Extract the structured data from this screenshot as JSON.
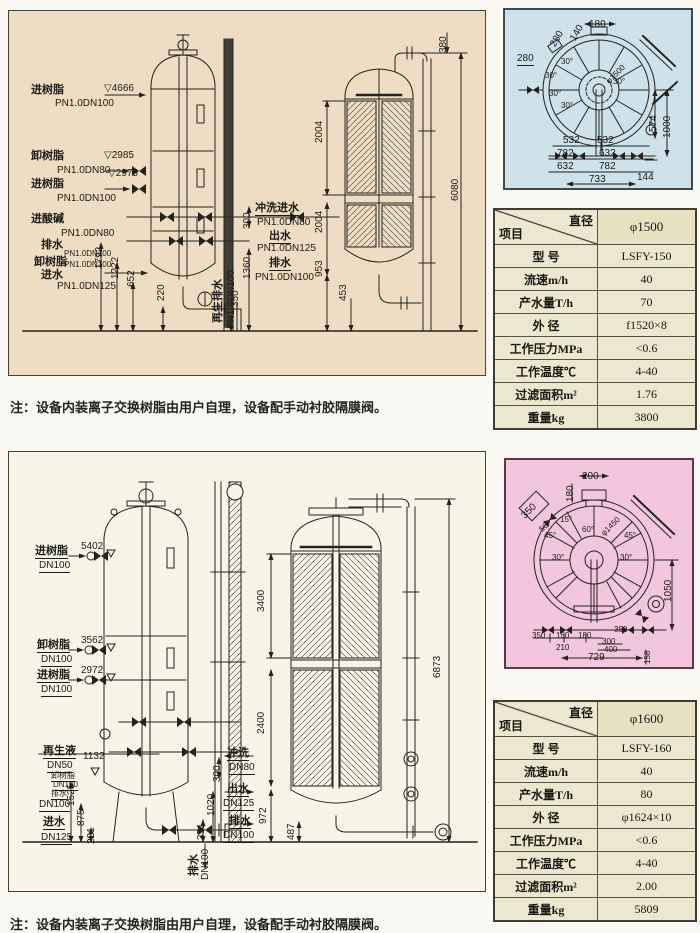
{
  "note_top": "注：设备内装离子交换树脂由用户自理，设备配手动衬胶隔膜阀。",
  "note_bottom": "注：设备内装离子交换树脂由用户自理，设备配手动衬胶隔膜阀。",
  "colors": {
    "top_panel_bg": "#eeddc3",
    "bottom_panel_bg": "#f6f5e8",
    "blue_view_bg": "#cde2ea",
    "pink_view_bg": "#f2c6de",
    "table_bg": "#ebe8cf",
    "line": "#23221e"
  },
  "table_top": {
    "header_diag_top": "直径",
    "header_diag_bottom": "项目",
    "header_value": "φ1500",
    "rows": [
      {
        "label": "型  号",
        "value": "LSFY-150"
      },
      {
        "label": "流速m/h",
        "value": "40"
      },
      {
        "label": "产水量T/h",
        "value": "70"
      },
      {
        "label": "外  径",
        "value": "f1520×8"
      },
      {
        "label": "工作压力MPa",
        "value": "<0.6"
      },
      {
        "label": "工作温度℃",
        "value": "4-40"
      },
      {
        "label": "过滤面积m²",
        "value": "1.76"
      },
      {
        "label": "重量kg",
        "value": "3800"
      }
    ]
  },
  "table_bottom": {
    "header_diag_top": "直径",
    "header_diag_bottom": "项目",
    "header_value": "φ1600",
    "rows": [
      {
        "label": "型  号",
        "value": "LSFY-160"
      },
      {
        "label": "流速m/h",
        "value": "40"
      },
      {
        "label": "产水量T/h",
        "value": "80"
      },
      {
        "label": "外  径",
        "value": "φ1624×10"
      },
      {
        "label": "工作压力MPa",
        "value": "<0.6"
      },
      {
        "label": "工作温度℃",
        "value": "4-40"
      },
      {
        "label": "过滤面积m²",
        "value": "2.00"
      },
      {
        "label": "重量kg",
        "value": "5809"
      }
    ]
  },
  "drawing_top": {
    "labels": [
      {
        "t": "进树脂",
        "x": 22,
        "y": 74,
        "c": "cn"
      },
      {
        "t": "PN1.0DN100",
        "x": 46,
        "y": 88
      },
      {
        "t": "▽4666",
        "x": 95,
        "y": 73
      },
      {
        "t": "卸树脂",
        "x": 22,
        "y": 140,
        "c": "cn"
      },
      {
        "t": "▽2985",
        "x": 95,
        "y": 140
      },
      {
        "t": "PN1.0DN80",
        "x": 48,
        "y": 155
      },
      {
        "t": "▽2975",
        "x": 99,
        "y": 158
      },
      {
        "t": "进树脂",
        "x": 22,
        "y": 168,
        "c": "cn"
      },
      {
        "t": "PN1.0DN100",
        "x": 48,
        "y": 183
      },
      {
        "t": "进酸碱",
        "x": 22,
        "y": 203,
        "c": "cn"
      },
      {
        "t": "PN1.0DN80",
        "x": 52,
        "y": 218
      },
      {
        "t": "排水",
        "x": 32,
        "y": 229,
        "c": "cn"
      },
      {
        "t": "PN1.0DN100",
        "x": 55,
        "y": 239,
        "c": "s"
      },
      {
        "t": "卸树脂",
        "x": 25,
        "y": 246,
        "c": "cn"
      },
      {
        "t": "PN1.0DN100",
        "x": 55,
        "y": 250,
        "c": "s"
      },
      {
        "t": "进水",
        "x": 32,
        "y": 259,
        "c": "cn"
      },
      {
        "t": "PN1.0DN125",
        "x": 48,
        "y": 271
      },
      {
        "t": "冲洗进水",
        "x": 246,
        "y": 192,
        "c": "cn u"
      },
      {
        "t": "PN1.0DN80",
        "x": 248,
        "y": 207
      },
      {
        "t": "出水",
        "x": 260,
        "y": 220,
        "c": "cn u"
      },
      {
        "t": "PN1.0DN125",
        "x": 248,
        "y": 233
      },
      {
        "t": "排水",
        "x": 260,
        "y": 247,
        "c": "cn u"
      },
      {
        "t": "PN1.0DN100",
        "x": 246,
        "y": 262
      },
      {
        "t": "1792",
        "x": 86,
        "y": 258,
        "c": "r"
      },
      {
        "t": "1222",
        "x": 102,
        "y": 268,
        "c": "r"
      },
      {
        "t": "652",
        "x": 118,
        "y": 276,
        "c": "r"
      },
      {
        "t": "220",
        "x": 148,
        "y": 290,
        "c": "r"
      },
      {
        "t": "350",
        "x": 222,
        "y": 296,
        "c": "r"
      },
      {
        "t": "再生排水",
        "x": 204,
        "y": 312,
        "c": "r cn"
      },
      {
        "t": "PN1.0DN100",
        "x": 218,
        "y": 318,
        "c": "r"
      },
      {
        "t": "300",
        "x": 234,
        "y": 218,
        "c": "r"
      },
      {
        "t": "1360",
        "x": 234,
        "y": 268,
        "c": "r"
      },
      {
        "t": "2004",
        "x": 306,
        "y": 132,
        "c": "r"
      },
      {
        "t": "2004",
        "x": 306,
        "y": 222,
        "c": "r"
      },
      {
        "t": "953",
        "x": 306,
        "y": 266,
        "c": "r"
      },
      {
        "t": "453",
        "x": 330,
        "y": 290,
        "c": "r"
      },
      {
        "t": "380",
        "x": 430,
        "y": 42,
        "c": "r"
      },
      {
        "t": "6080",
        "x": 442,
        "y": 190,
        "c": "r"
      }
    ]
  },
  "drawing_bottom": {
    "labels": [
      {
        "t": "进树脂",
        "x": 26,
        "y": 94,
        "c": "cn u"
      },
      {
        "t": "DN100",
        "x": 30,
        "y": 109,
        "c": "u"
      },
      {
        "t": "5402",
        "x": 72,
        "y": 90
      },
      {
        "t": "卸树脂",
        "x": 28,
        "y": 188,
        "c": "cn u"
      },
      {
        "t": "DN100",
        "x": 32,
        "y": 203,
        "c": "u"
      },
      {
        "t": "3562",
        "x": 72,
        "y": 184
      },
      {
        "t": "进树脂",
        "x": 28,
        "y": 218,
        "c": "cn u"
      },
      {
        "t": "DN100",
        "x": 32,
        "y": 233,
        "c": "u"
      },
      {
        "t": "2972",
        "x": 72,
        "y": 214
      },
      {
        "t": "再生液",
        "x": 34,
        "y": 294,
        "c": "cn u"
      },
      {
        "t": "DN50",
        "x": 38,
        "y": 309,
        "c": "u"
      },
      {
        "t": "1132",
        "x": 74,
        "y": 300
      },
      {
        "t": "卸树脂",
        "x": 42,
        "y": 320,
        "c": "s u"
      },
      {
        "t": "DN100",
        "x": 44,
        "y": 329,
        "c": "s u"
      },
      {
        "t": "排水",
        "x": 42,
        "y": 338,
        "c": "s u"
      },
      {
        "t": "DN100",
        "x": 30,
        "y": 348,
        "c": "u"
      },
      {
        "t": "1525",
        "x": 58,
        "y": 354,
        "c": "r"
      },
      {
        "t": "进水",
        "x": 34,
        "y": 365,
        "c": "cn u"
      },
      {
        "t": "DN125",
        "x": 32,
        "y": 381,
        "c": "u"
      },
      {
        "t": "875",
        "x": 68,
        "y": 374,
        "c": "r"
      },
      {
        "t": "221",
        "x": 78,
        "y": 392,
        "c": "r"
      },
      {
        "t": "冲洗",
        "x": 218,
        "y": 296,
        "c": "cn u"
      },
      {
        "t": "DN80",
        "x": 220,
        "y": 311,
        "c": "u"
      },
      {
        "t": "300",
        "x": 204,
        "y": 330,
        "c": "r"
      },
      {
        "t": "出水",
        "x": 218,
        "y": 332,
        "c": "cn u"
      },
      {
        "t": "DN125",
        "x": 214,
        "y": 347,
        "c": "u"
      },
      {
        "t": "1020",
        "x": 198,
        "y": 364,
        "c": "r"
      },
      {
        "t": "排水",
        "x": 220,
        "y": 364,
        "c": "cn u"
      },
      {
        "t": "DN100",
        "x": 214,
        "y": 379,
        "c": "u"
      },
      {
        "t": "351",
        "x": 188,
        "y": 388,
        "c": "r"
      },
      {
        "t": "排水",
        "x": 180,
        "y": 424,
        "c": "r cn"
      },
      {
        "t": "DN100",
        "x": 192,
        "y": 428,
        "c": "r"
      },
      {
        "t": "3400",
        "x": 248,
        "y": 160,
        "c": "r"
      },
      {
        "t": "2400",
        "x": 248,
        "y": 282,
        "c": "r"
      },
      {
        "t": "972",
        "x": 250,
        "y": 372,
        "c": "r"
      },
      {
        "t": "487",
        "x": 278,
        "y": 388,
        "c": "r"
      },
      {
        "t": "6873",
        "x": 424,
        "y": 226,
        "c": "r"
      }
    ]
  },
  "topview_blue": {
    "labels": [
      {
        "t": "180",
        "x": 84,
        "y": 10
      },
      {
        "t": "140",
        "x": 64,
        "y": 28,
        "c": "r60"
      },
      {
        "t": "280",
        "x": 44,
        "y": 34,
        "c": "r60"
      },
      {
        "t": "280",
        "x": 12,
        "y": 44,
        "c": "u"
      },
      {
        "t": "30°",
        "x": 56,
        "y": 48,
        "c": "s"
      },
      {
        "t": "30°",
        "x": 40,
        "y": 62,
        "c": "s"
      },
      {
        "t": "30°",
        "x": 44,
        "y": 80,
        "c": "s"
      },
      {
        "t": "30°",
        "x": 108,
        "y": 68,
        "c": "s"
      },
      {
        "t": "30°",
        "x": 56,
        "y": 92,
        "c": "s"
      },
      {
        "t": "φ1500",
        "x": 100,
        "y": 70,
        "c": "r45 s"
      },
      {
        "t": "574",
        "x": 144,
        "y": 122,
        "c": "r"
      },
      {
        "t": "1000",
        "x": 158,
        "y": 128,
        "c": "r"
      },
      {
        "t": "532",
        "x": 58,
        "y": 126
      },
      {
        "t": "532",
        "x": 92,
        "y": 126
      },
      {
        "t": "782",
        "x": 52,
        "y": 139
      },
      {
        "t": "632",
        "x": 94,
        "y": 139
      },
      {
        "t": "632",
        "x": 52,
        "y": 152
      },
      {
        "t": "782",
        "x": 94,
        "y": 152
      },
      {
        "t": "733",
        "x": 84,
        "y": 165
      },
      {
        "t": "144",
        "x": 132,
        "y": 163
      }
    ]
  },
  "topview_pink": {
    "labels": [
      {
        "t": "200",
        "x": 76,
        "y": 12
      },
      {
        "t": "180",
        "x": 60,
        "y": 42,
        "c": "r"
      },
      {
        "t": "350",
        "x": 14,
        "y": 54,
        "c": "r45"
      },
      {
        "t": "56",
        "x": 32,
        "y": 68,
        "c": "r45 s"
      },
      {
        "t": "15°",
        "x": 54,
        "y": 56,
        "c": "s"
      },
      {
        "t": "45°",
        "x": 38,
        "y": 72,
        "c": "s"
      },
      {
        "t": "45°",
        "x": 118,
        "y": 72,
        "c": "s"
      },
      {
        "t": "60°",
        "x": 76,
        "y": 66,
        "c": "s"
      },
      {
        "t": "φ1450",
        "x": 94,
        "y": 72,
        "c": "r45 s"
      },
      {
        "t": "30°",
        "x": 46,
        "y": 94,
        "c": "s"
      },
      {
        "t": "30°",
        "x": 114,
        "y": 94,
        "c": "s"
      },
      {
        "t": "1050",
        "x": 158,
        "y": 142,
        "c": "r"
      },
      {
        "t": "350",
        "x": 26,
        "y": 172,
        "c": "s"
      },
      {
        "t": "150",
        "x": 50,
        "y": 172,
        "c": "s"
      },
      {
        "t": "180",
        "x": 72,
        "y": 172,
        "c": "s"
      },
      {
        "t": "350",
        "x": 108,
        "y": 166,
        "c": "s"
      },
      {
        "t": "210",
        "x": 50,
        "y": 184,
        "c": "s"
      },
      {
        "t": "300",
        "x": 96,
        "y": 178,
        "c": "s"
      },
      {
        "t": "400",
        "x": 98,
        "y": 186,
        "c": "s"
      },
      {
        "t": "729",
        "x": 82,
        "y": 193
      },
      {
        "t": "158",
        "x": 138,
        "y": 204,
        "c": "r s"
      }
    ]
  }
}
